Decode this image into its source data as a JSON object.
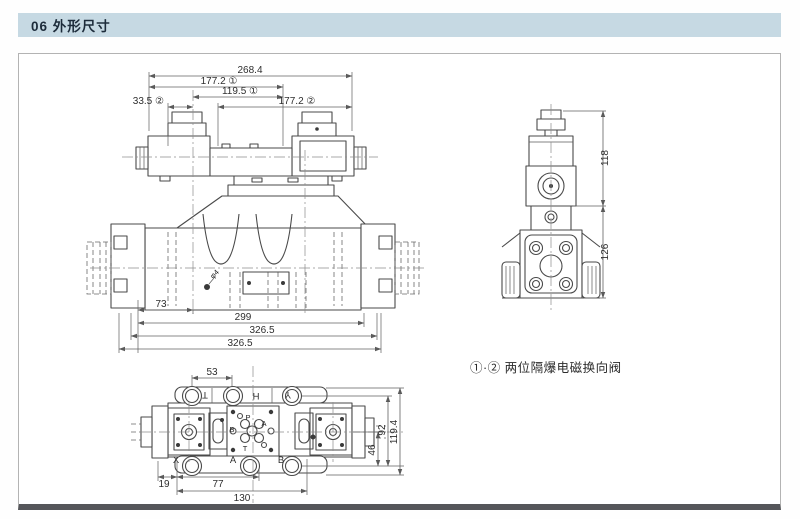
{
  "header": {
    "title": "06 外形尺寸"
  },
  "front_view": {
    "dims": {
      "overall_top": "268.4",
      "d177_1": "177.2 ①",
      "d119_1": "119.5 ①",
      "d33_2": "33.5 ②",
      "d177_2": "177.2 ②",
      "d73": "73",
      "d299": "299",
      "d326_a": "326.5",
      "d326_b": "326.5",
      "hole": "φ4"
    }
  },
  "side_view": {
    "dims": {
      "d118": "118",
      "d126": "126"
    }
  },
  "bottom_view": {
    "dims": {
      "d53": "53",
      "d19": "19",
      "d77": "77",
      "d130": "130",
      "d46": "46",
      "d92": "92",
      "d119": "119.4"
    },
    "ports": {
      "top_1": "T",
      "top_2": "H",
      "top_3": "Y",
      "bottom_1": "X",
      "bottom_2": "A",
      "bottom_3": "B",
      "face_p": "P",
      "face_a": "A",
      "face_b": "B",
      "face_t": "T"
    }
  },
  "note": {
    "text": "①·② 两位隔爆电磁换向阀"
  }
}
